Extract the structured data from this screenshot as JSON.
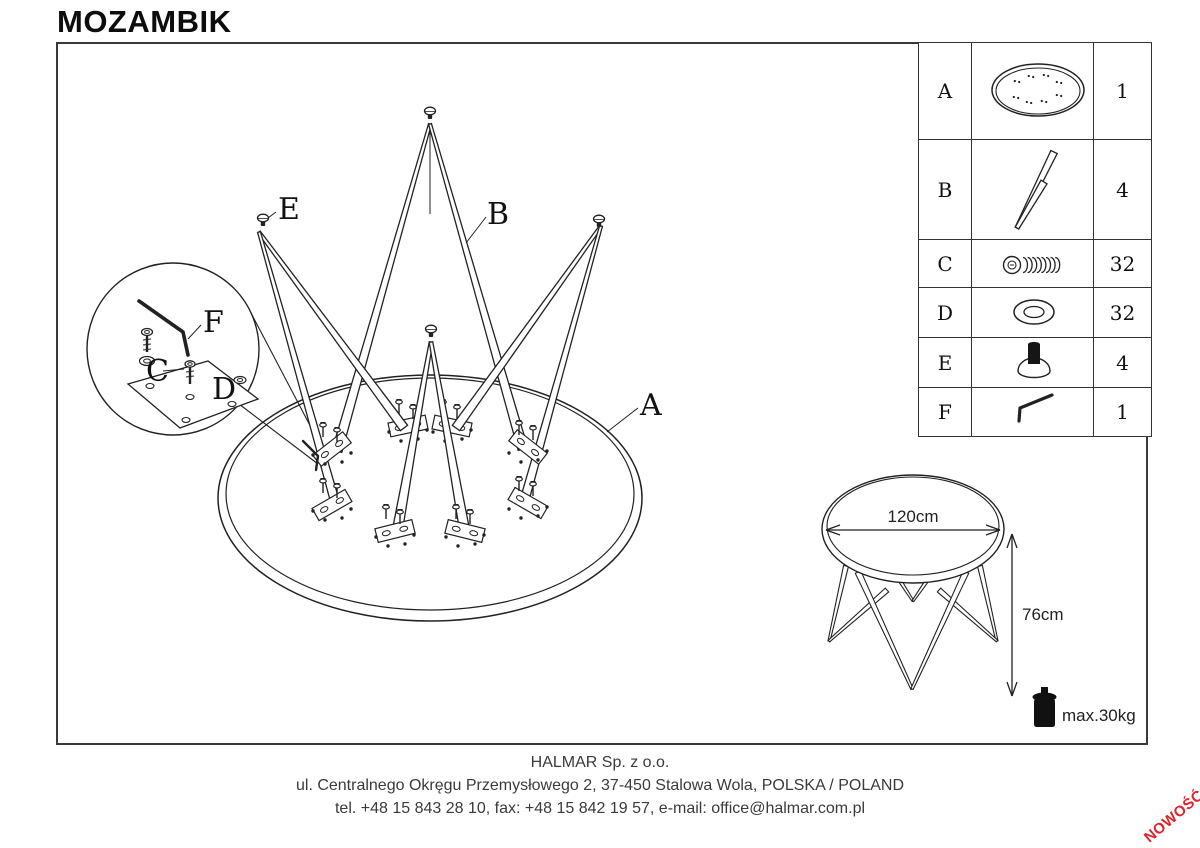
{
  "title": "MOZAMBIK",
  "parts_table": {
    "rows": [
      {
        "letter": "A",
        "icon": "tabletop-icon",
        "qty": "1"
      },
      {
        "letter": "B",
        "icon": "leg-icon",
        "qty": "4"
      },
      {
        "letter": "C",
        "icon": "screw-icon",
        "qty": "32"
      },
      {
        "letter": "D",
        "icon": "washer-icon",
        "qty": "32"
      },
      {
        "letter": "E",
        "icon": "foot-icon",
        "qty": "4"
      },
      {
        "letter": "F",
        "icon": "allen-key-icon",
        "qty": "1"
      }
    ]
  },
  "diagram_labels": {
    "tabletop": "A",
    "leg": "B",
    "screw": "C",
    "washer": "D",
    "foot": "E",
    "allen_key": "F"
  },
  "dimensions": {
    "diameter": "120cm",
    "height": "76cm",
    "max_load": "max.30kg"
  },
  "footer": {
    "company": "HALMAR Sp. z o.o.",
    "address": "ul. Centralnego Okręgu Przemysłowego 2, 37-450 Stalowa Wola, POLSKA / POLAND",
    "contact": "tel. +48 15 843 28 10, fax: +48 15 842 19 57, e-mail: office@halmar.com.pl"
  },
  "badge": {
    "text": "NOWOŚĆ",
    "color": "#e1222b"
  },
  "colors": {
    "line": "#222222",
    "border": "#3a3a3a",
    "background": "#ffffff"
  }
}
